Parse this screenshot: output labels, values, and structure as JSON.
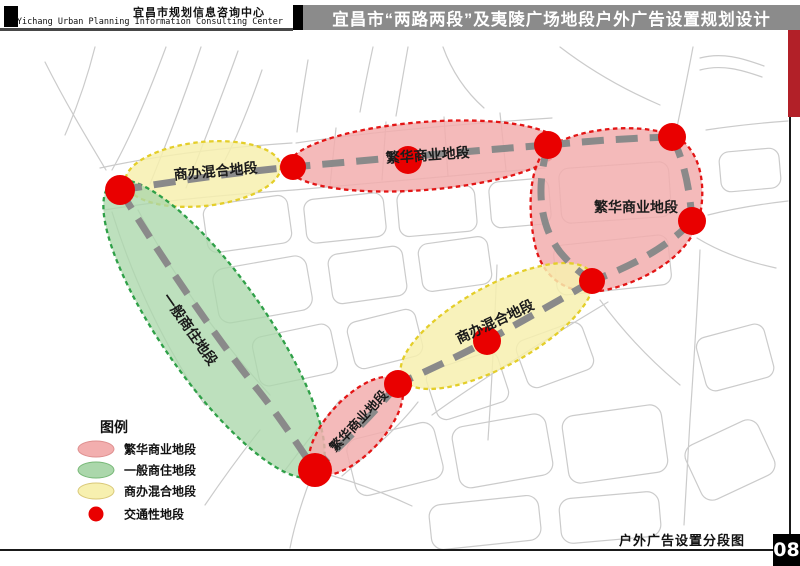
{
  "header": {
    "org_zh": "宜昌市规划信息咨询中心",
    "org_en": "Yichang Urban Planning Information Consulting Center",
    "title": "宜昌市“两路两段”及夷陵广场地段户外广告设置规划设计"
  },
  "map": {
    "zones": [
      {
        "label": "商办混合地段",
        "type": "mixed",
        "position": "northwest"
      },
      {
        "label": "繁华商业地段",
        "type": "commercial",
        "position": "north"
      },
      {
        "label": "繁华商业地段",
        "type": "commercial",
        "position": "east"
      },
      {
        "label": "商办混合地段",
        "type": "mixed",
        "position": "central-diagonal"
      },
      {
        "label": "繁华商业地段",
        "type": "commercial",
        "position": "south"
      },
      {
        "label": "一般商住地段",
        "type": "residential",
        "position": "west"
      }
    ],
    "traffic_nodes": 10
  },
  "legend": {
    "title": "图例",
    "items": [
      {
        "label": "繁华商业地段",
        "color": "#F2AEAE",
        "border": "#DE8F8F",
        "type": "ellipse"
      },
      {
        "label": "一般商住地段",
        "color": "#ABD7AB",
        "border": "#77B877",
        "type": "ellipse"
      },
      {
        "label": "商办混合地段",
        "color": "#F7F0AF",
        "border": "#D9C878",
        "type": "ellipse"
      },
      {
        "label": "交通性地段",
        "color": "#E90000",
        "border": "#E90000",
        "type": "dot"
      }
    ]
  },
  "footer": {
    "caption": "户外广告设置分段图",
    "page": "08"
  },
  "colors": {
    "street": "#CBCBCB",
    "road": "#8A8A8A",
    "commercial_fill": "#F2AEAE",
    "commercial_border": "#E31515",
    "residential_fill": "#ABD7AB",
    "residential_border": "#2FA048",
    "mixed_fill": "#F7F0AF",
    "mixed_border": "#E4CE2A",
    "traffic_dot": "#E90000",
    "header_bar": "#8B8B8B",
    "accent_red": "#B22028"
  }
}
